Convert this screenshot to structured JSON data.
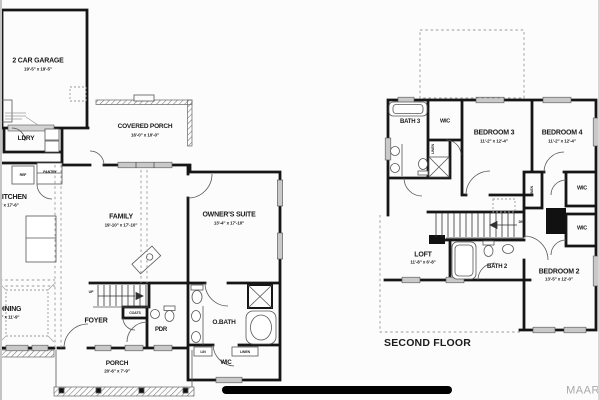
{
  "colors": {
    "wall": "#161616",
    "thin_line": "#555555",
    "window_fill": "#c9c9c9",
    "dashed": "#999999",
    "label": "#1b1b1b",
    "watermark": "#a8a8a8",
    "redaction": "#000000",
    "background": "#fcfcfc"
  },
  "watermark": "MAAR",
  "first_floor": {
    "stair_direction": "UP",
    "rooms": {
      "garage": {
        "name": "2 CAR GARAGE",
        "dim": "19'-5\" x 19'-5\""
      },
      "covered_porch": {
        "name": "COVERED PORCH",
        "dim": "16'-0\" x 10'-0\""
      },
      "laundry": {
        "name": "LDRY"
      },
      "kitchen": {
        "name": "KITCHEN",
        "dim": "11'-5\" x 17'-6\""
      },
      "family": {
        "name": "FAMILY",
        "dim": "19'-10\" x 17'-10\""
      },
      "owners_suite": {
        "name": "OWNER'S SUITE",
        "dim": "13'-4\" x 17'-10\""
      },
      "dining": {
        "name": "DINING",
        "dim": "11'-5\" x 11'-9\""
      },
      "foyer": {
        "name": "FOYER"
      },
      "powder": {
        "name": "PDR"
      },
      "owners_bath": {
        "name": "O.BATH"
      },
      "wic": {
        "name": "WIC"
      },
      "porch": {
        "name": "PORCH",
        "dim": "20'-6\" x 7'-9\""
      }
    },
    "closets": {
      "coats": "COATS",
      "lin": "LIN",
      "linen": "LINEN"
    },
    "appliances": {
      "ref": "REF",
      "pantry": "PANTRY"
    }
  },
  "second_floor": {
    "title": "SECOND FLOOR",
    "stair_direction": "DN",
    "rooms": {
      "bath3": {
        "name": "BATH 3"
      },
      "wic_hall": {
        "name": "WIC"
      },
      "bedroom3": {
        "name": "BEDROOM 3",
        "dim": "11'-2\" x 12'-4\""
      },
      "bedroom4": {
        "name": "BEDROOM 4",
        "dim": "11'-2\" x 12'-4\""
      },
      "loft": {
        "name": "LOFT",
        "dim": "11'-8\" x 6'-8\""
      },
      "bath2": {
        "name": "BATH 2"
      },
      "bedroom2": {
        "name": "BEDROOM 2",
        "dim": "13'-5\" x 12'-0\""
      },
      "wic_bedroom4": {
        "name": "WIC"
      },
      "wic_bedroom2": {
        "name": "WIC"
      }
    },
    "closets": {
      "linen_hall": "LINEN",
      "linen_bedroom2": "LINEN"
    }
  }
}
